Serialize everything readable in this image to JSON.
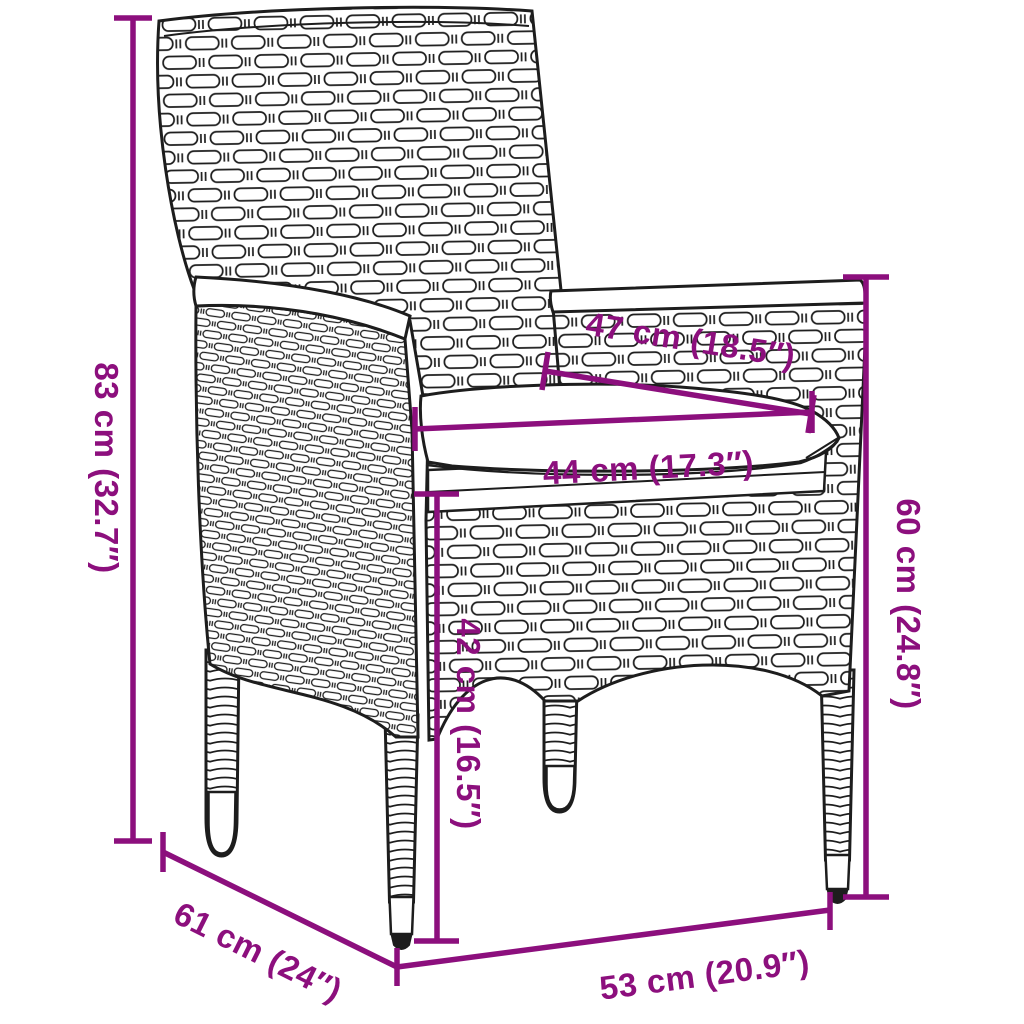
{
  "diagram": {
    "type": "product-dimension-diagram",
    "subject": "poly-rattan garden chair with seat cushion",
    "background_color": "#ffffff",
    "artwork_line_color": "#1d1d1d",
    "dimension_color": "#8C0F7D",
    "dimensions": {
      "back_height": {
        "label": "83 cm (32.7″)",
        "cm": 83,
        "inches": 32.7,
        "placement": "left-vertical"
      },
      "seat_width": {
        "label": "47 cm (18.5″)",
        "cm": 47,
        "inches": 18.5,
        "placement": "seat-diagonal"
      },
      "cushion_width": {
        "label": "44 cm (17.3″)",
        "cm": 44,
        "inches": 17.3,
        "placement": "seat-horizontal"
      },
      "seat_height": {
        "label": "42 cm (16.5″)",
        "cm": 42,
        "inches": 16.5,
        "placement": "center-vertical"
      },
      "armrest_height": {
        "label": "60 cm (24.8″)",
        "cm": 60,
        "inches": 24.8,
        "placement": "right-vertical"
      },
      "depth": {
        "label": "61 cm (24″)",
        "cm": 61,
        "inches": 24,
        "placement": "bottom-left-diagonal"
      },
      "width": {
        "label": "53 cm (20.9″)",
        "cm": 53,
        "inches": 20.9,
        "placement": "bottom-horizontal"
      }
    }
  }
}
